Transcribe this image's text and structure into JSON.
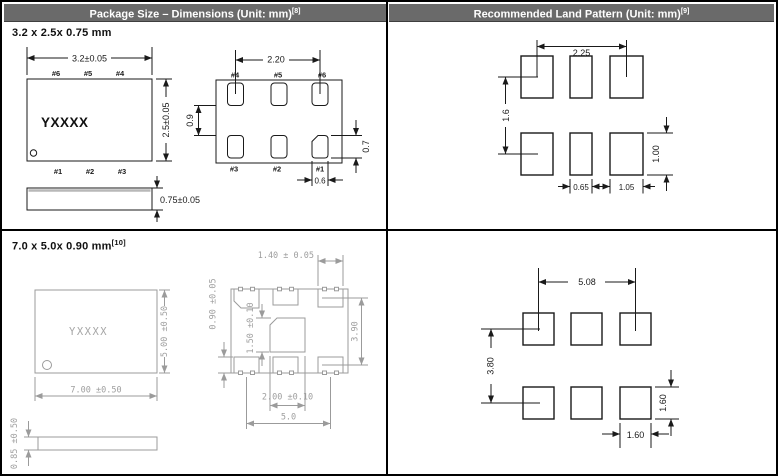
{
  "colors": {
    "header_bg": "#6a6a6a",
    "header_text": "#ffffff",
    "ink": "#1a1a1a",
    "cad_gray": "#9b9b9b"
  },
  "headers": {
    "left": {
      "label": "Package Size – Dimensions (Unit: mm)",
      "sup": "[8]"
    },
    "right": {
      "label": "Recommended Land Pattern (Unit: mm)",
      "sup": "[9]"
    }
  },
  "pkg3225": {
    "title": "3.2 x 2.5x 0.75 mm",
    "top_view": {
      "marking": "YXXXX",
      "width_dim": "3.2±0.05",
      "height_dim": "2.5±0.05",
      "thickness_dim": "0.75±0.05",
      "pins_top": [
        "#6",
        "#5",
        "#4"
      ],
      "pins_bottom": [
        "#1",
        "#2",
        "#3"
      ]
    },
    "bottom_view": {
      "pitch_dim": "2.20",
      "row_gap_dim": "0.9",
      "pad_height_dim": "0.7",
      "pad_width_dim": "0.6",
      "pins_top": [
        "#4",
        "#5",
        "#6"
      ],
      "pins_bottom": [
        "#3",
        "#2",
        "#1"
      ]
    }
  },
  "land3225": {
    "pitch_x": "2.25",
    "row_gap": "1.6",
    "pad_height": "1.00",
    "center_pad_width": "0.65",
    "outer_pad_width": "1.05"
  },
  "pkg7050": {
    "title": "7.0 x 5.0x 0.90 mm",
    "title_sup": "[10]",
    "top_view": {
      "marking": "YXXXX",
      "width_dim": "7.00 ±0.50",
      "height_dim": "5.00 ±0.50",
      "thickness_dim": "0.85 ±0.50"
    },
    "bottom_view": {
      "corner_pad_width_dim": "1.40 ± 0.05",
      "pad_height_dim": "0.90 ±0.05",
      "center_pad_height_dim": "1.50 ±0.10",
      "row_span_dim": "3.90",
      "center_pad_width_dim": "2.00 ±0.10",
      "pitch_dim": "5.0"
    }
  },
  "land7050": {
    "pitch_x": "5.08",
    "pitch_y": "3.80",
    "pad_height": "1.60",
    "pad_width": "1.60"
  }
}
